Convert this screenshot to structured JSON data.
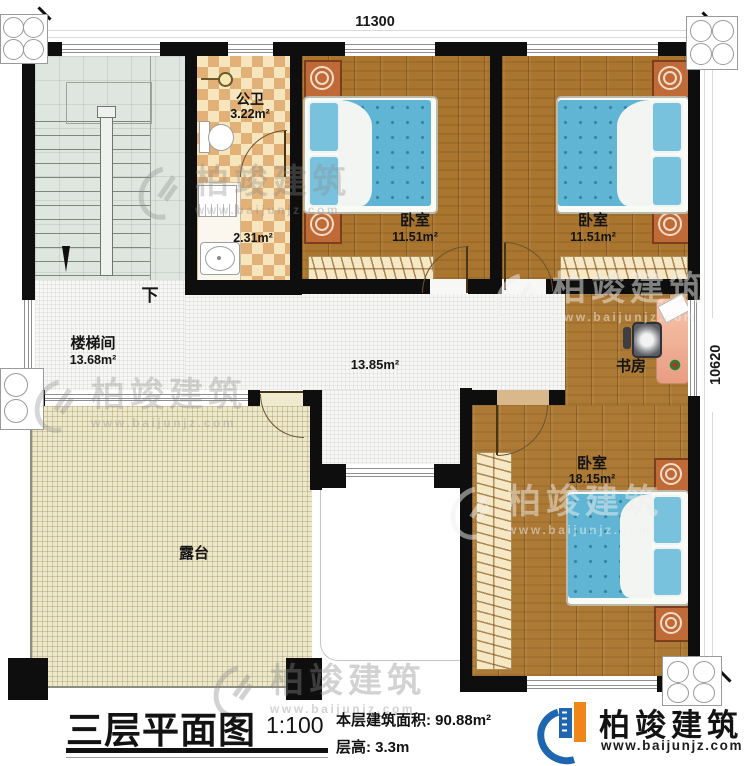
{
  "dimensions": {
    "top": "11300",
    "right": "10620"
  },
  "rooms": {
    "stairwell": {
      "name": "楼梯间",
      "area": "13.68m²",
      "direction_label": "下"
    },
    "bathroom": {
      "name": "公卫",
      "area": "3.22m²"
    },
    "washroom": {
      "area": "2.31m²"
    },
    "bedroom_top_left": {
      "name": "卧室",
      "area": "11.51m²"
    },
    "bedroom_top_right": {
      "name": "卧室",
      "area": "11.51m²"
    },
    "hallway": {
      "area": "13.85m²"
    },
    "study": {
      "name": "书房"
    },
    "bedroom_bottom": {
      "name": "卧室",
      "area": "18.15m²"
    },
    "terrace": {
      "name": "露台"
    }
  },
  "title_block": {
    "title": "三层平面图",
    "scale": "1:100",
    "floor_area": "本层建筑面积: 90.88m²",
    "floor_height": "层高: 3.3m"
  },
  "brand": {
    "name": "柏竣建筑",
    "website": "www.baijunjz.com"
  },
  "watermark": {
    "name": "柏竣建筑",
    "website": "www.baijunjz.com"
  },
  "colors": {
    "wall": "#0e0e0e",
    "wood_floor": "#a9752f",
    "mattress_blue": "#5fb4d4",
    "terrace_floor": "#eee8cb",
    "checker_tan": "#e2b177",
    "stair_floor": "#dfe5df",
    "hall_floor": "#f7f7f6",
    "brand_blue": "#1e66b0",
    "brand_orange": "#f08519"
  }
}
